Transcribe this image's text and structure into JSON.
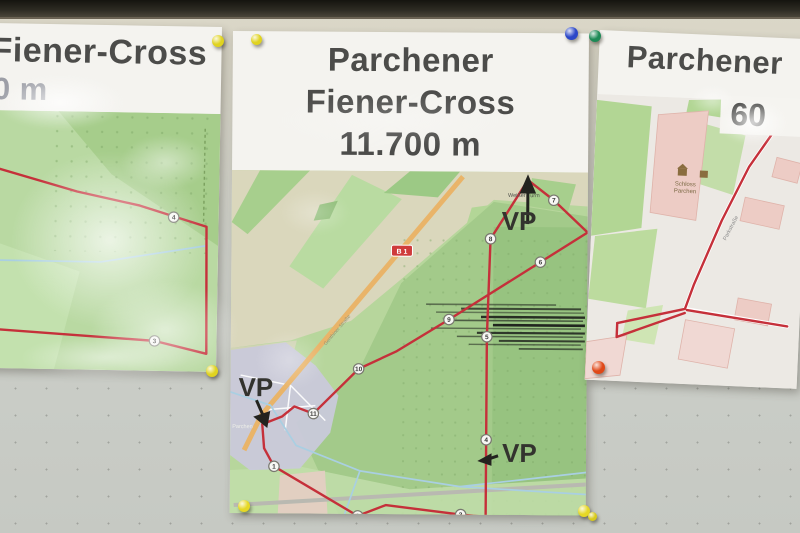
{
  "posters": {
    "left": {
      "title": "Fiener-Cross",
      "distance_partial": "0 m",
      "route": [
        [
          0,
          55
        ],
        [
          36,
          58
        ],
        [
          116,
          80
        ],
        [
          179,
          93
        ],
        [
          246,
          113
        ],
        [
          248,
          240
        ],
        [
          196,
          228
        ],
        [
          36,
          219
        ],
        [
          0,
          216
        ]
      ],
      "stream": [
        [
          0,
          152
        ],
        [
          36,
          150
        ],
        [
          141,
          150
        ],
        [
          246,
          132
        ]
      ],
      "checkpoints": [
        {
          "n": "4",
          "x": 213,
          "y": 104
        },
        {
          "n": "3",
          "x": 196,
          "y": 228
        }
      ]
    },
    "center": {
      "title_line1": "Parchener",
      "title_line2": "Fiener-Cross",
      "title_line3": "11.700 m",
      "vp": "VP",
      "landmark_label": "Weißer Turm",
      "road_badge": "B 1",
      "village_label": "Parchen",
      "street_label": "Genthiner Straße",
      "route": [
        [
          296,
          8
        ],
        [
          322,
          28
        ],
        [
          356,
          60
        ],
        [
          309,
          90
        ],
        [
          218,
          148
        ],
        [
          166,
          180
        ],
        [
          128,
          198
        ],
        [
          83,
          243
        ],
        [
          64,
          236
        ],
        [
          52,
          246
        ],
        [
          32,
          254
        ],
        [
          34,
          278
        ],
        [
          44,
          296
        ],
        [
          128,
          345
        ],
        [
          156,
          334
        ],
        [
          231,
          343
        ],
        [
          256,
          345
        ],
        [
          256,
          268
        ],
        [
          256,
          165
        ],
        [
          259,
          67
        ],
        [
          296,
          8
        ]
      ],
      "streams": [
        [
          [
            0,
            222
          ],
          [
            40,
            235
          ],
          [
            66,
            275
          ],
          [
            130,
            300
          ],
          [
            230,
            315
          ],
          [
            356,
            322
          ]
        ],
        [
          [
            130,
            300
          ],
          [
            114,
            346
          ]
        ],
        [
          [
            230,
            315
          ],
          [
            290,
            308
          ],
          [
            356,
            300
          ]
        ]
      ],
      "checkpoints": [
        {
          "n": "1",
          "x": 44,
          "y": 296
        },
        {
          "n": "2",
          "x": 128,
          "y": 345
        },
        {
          "n": "3",
          "x": 231,
          "y": 343
        },
        {
          "n": "4",
          "x": 256,
          "y": 268
        },
        {
          "n": "5",
          "x": 256,
          "y": 165
        },
        {
          "n": "6",
          "x": 309,
          "y": 90
        },
        {
          "n": "7",
          "x": 322,
          "y": 28
        },
        {
          "n": "8",
          "x": 259,
          "y": 67
        },
        {
          "n": "9",
          "x": 218,
          "y": 148
        },
        {
          "n": "10",
          "x": 128,
          "y": 198
        },
        {
          "n": "11",
          "x": 83,
          "y": 243
        }
      ]
    },
    "right": {
      "title": "Parchener",
      "distance_partial": "60",
      "landmark_label_1": "Schloss",
      "landmark_label_2": "Parchen",
      "street_label": "Parkstraße",
      "route_segments": [
        [
          [
            185,
            19
          ],
          [
            155,
            66
          ],
          [
            130,
            121
          ],
          [
            105,
            186
          ],
          [
            97,
            211
          ],
          [
            30,
            228
          ]
        ],
        [
          [
            30,
            228
          ],
          [
            30,
            242
          ],
          [
            97,
            215
          ]
        ],
        [
          [
            99,
            212
          ],
          [
            200,
            224
          ]
        ]
      ]
    }
  },
  "pins": [
    {
      "color": "yellow",
      "hex": "#e0d31f",
      "x": 218,
      "y": 41,
      "size": 12
    },
    {
      "color": "yellow",
      "hex": "#e0d31f",
      "x": 256,
      "y": 39,
      "size": 11
    },
    {
      "color": "blue",
      "hex": "#2b47c8",
      "x": 571,
      "y": 33,
      "size": 13
    },
    {
      "color": "green",
      "hex": "#1d8a56",
      "x": 595,
      "y": 36,
      "size": 12
    },
    {
      "color": "yellow",
      "hex": "#e0d31f",
      "x": 212,
      "y": 371,
      "size": 12
    },
    {
      "color": "yellow",
      "hex": "#e6d825",
      "x": 244,
      "y": 506,
      "size": 12
    },
    {
      "color": "yellow",
      "hex": "#e6d825",
      "x": 584,
      "y": 511,
      "size": 12
    },
    {
      "color": "yellow",
      "hex": "#d8ca1c",
      "x": 592,
      "y": 516,
      "size": 9
    },
    {
      "color": "orange-red",
      "hex": "#e04818",
      "x": 598,
      "y": 367,
      "size": 13
    }
  ],
  "colors": {
    "route_red": "#c5303a",
    "road_orange": "#e9b469",
    "stream_blue": "#a9cfe2"
  }
}
